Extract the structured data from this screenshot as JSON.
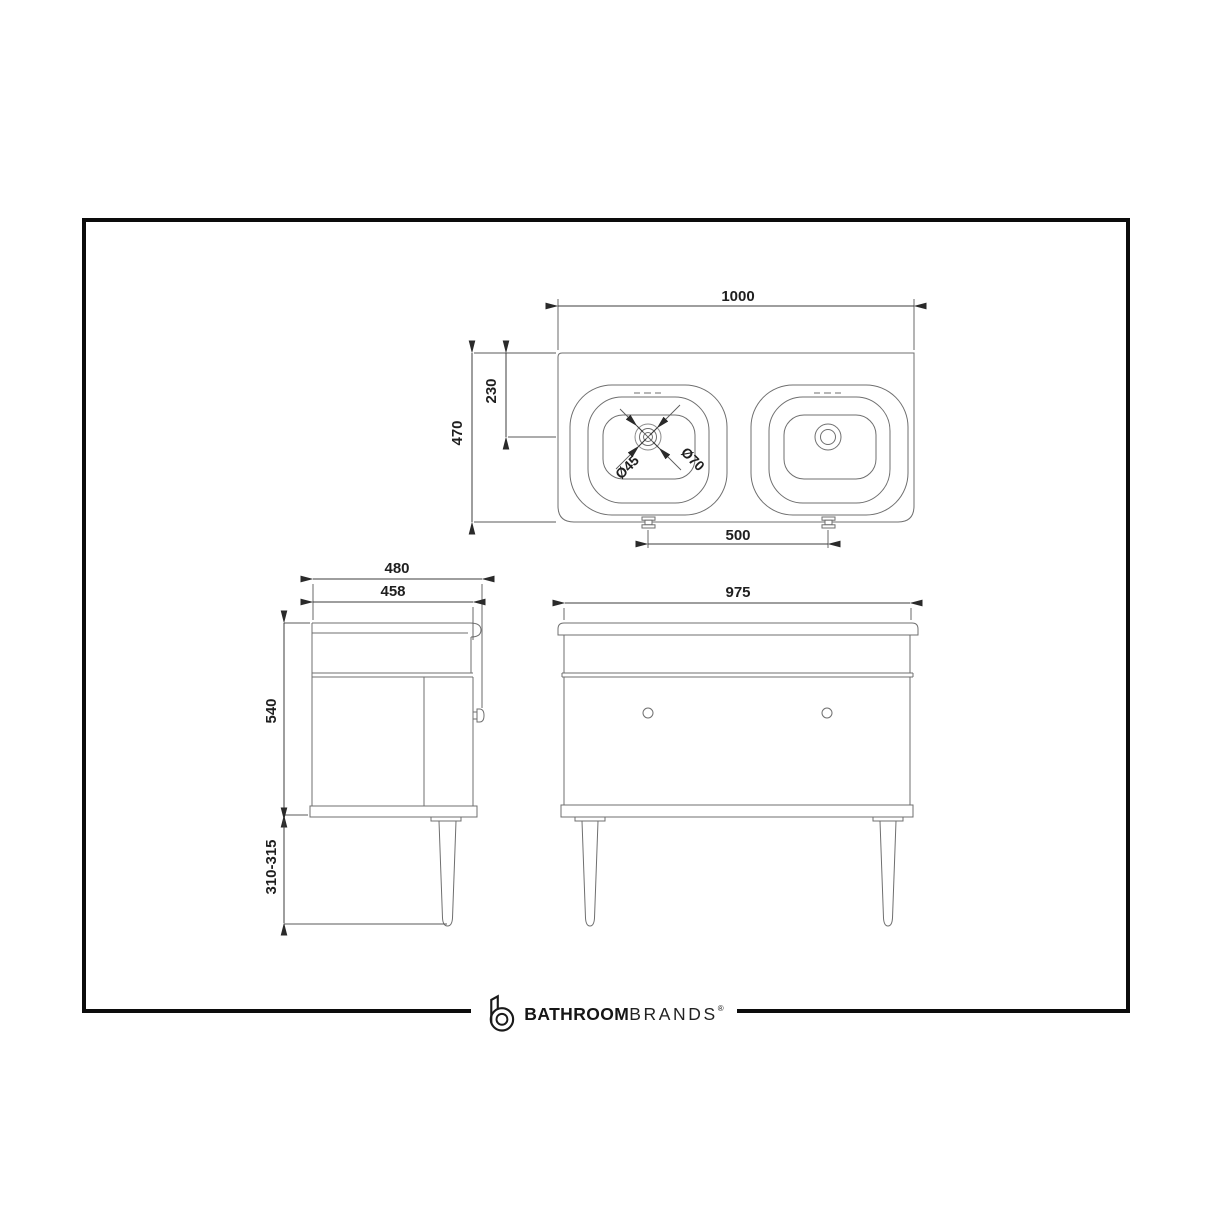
{
  "plan_view": {
    "overall_width": "1000",
    "overall_depth": "470",
    "bowl_centre_from_back": "230",
    "tap_hole_diameter": "Ø45",
    "waste_diameter": "Ø70",
    "bowl_centres": "500"
  },
  "side_view": {
    "overall_depth": "480",
    "carcase_depth": "458",
    "carcase_height": "540",
    "leg_height": "310-315"
  },
  "front_view": {
    "overall_width": "975"
  },
  "brand": {
    "word_bold": "BATHROOM",
    "word_light": "BRANDS",
    "registered": "®"
  },
  "colors": {
    "frame_border": "#0c0c0c",
    "object_line": "#6f6f6f",
    "dimension_line": "#3c3c3c",
    "text": "#1f1f1f",
    "background": "#ffffff"
  }
}
